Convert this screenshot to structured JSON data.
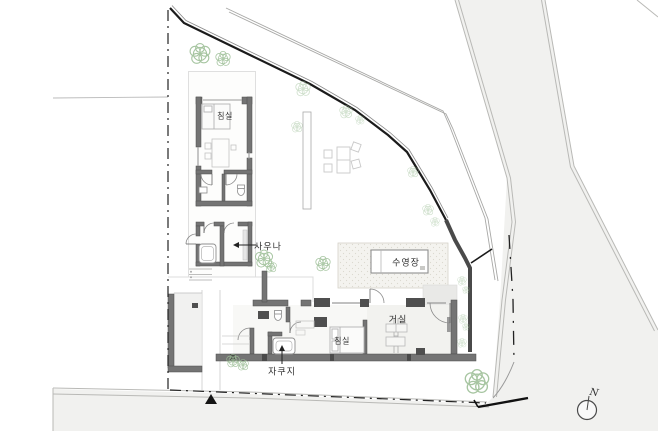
{
  "plan": {
    "rooms": {
      "bedroom_upper": "침실",
      "sauna": "사우나",
      "pool": "수영장",
      "living": "거실",
      "bedroom_lower": "침실",
      "jacuzzi": "자쿠지"
    },
    "compass": {
      "north": "N"
    },
    "colors": {
      "wall": "#747474",
      "pier": "#4f4f4f",
      "site_boundary": "#1b1b1b",
      "road_fill": "#f1f1ef",
      "deck_fill": "#f4f3ef",
      "tree_stroke": "#9dbf97",
      "label_text": "#2e2e2e"
    }
  }
}
